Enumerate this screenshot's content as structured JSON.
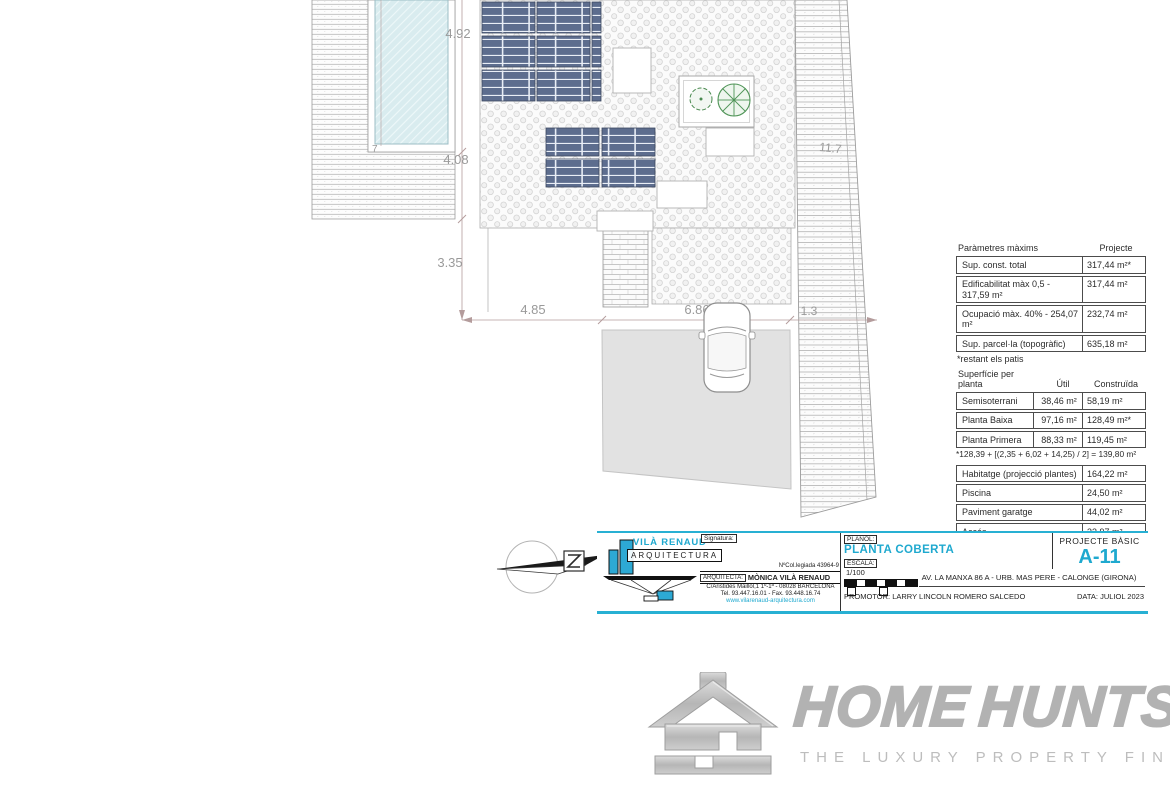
{
  "colors": {
    "accent_cyan": "#28b0d3",
    "panel_blue": "#5d6d8e",
    "tree_green": "#4f9457",
    "dimension_gray": "#9a9a9a",
    "watermark_gray": "#b2b2b2"
  },
  "plan": {
    "dim_pool_height": "4.92",
    "dim_deck_height": "4.08",
    "dim_mid_height": "3.35",
    "dim_left_width": "4.85",
    "dim_garage_width": "6.86",
    "dim_right_width": "1.3",
    "dim_ramp_length": "11.7",
    "dim_pool_inner": "7"
  },
  "params_table": {
    "header": {
      "left": "Paràmetres màxims",
      "right": "Projecte"
    },
    "rows": [
      {
        "label": "Sup. const. total",
        "value": "317,44 m²*"
      },
      {
        "label": "Edificabilitat màx 0,5 - 317,59 m²",
        "value": "317,44 m²"
      },
      {
        "label": "Ocupació màx. 40% - 254,07 m²",
        "value": "232,74 m²"
      },
      {
        "label": "Sup. parcel·la (topogràfic)",
        "value": "635,18 m²"
      }
    ],
    "footnote": "*restant els patis"
  },
  "surface_table": {
    "header": {
      "col1": "Superfície per planta",
      "col2": "Útil",
      "col3": "Construïda"
    },
    "rows": [
      {
        "label": "Semisoterrani",
        "util": "38,46 m²",
        "built": "58,19 m²"
      },
      {
        "label": "Planta Baixa",
        "util": "97,16 m²",
        "built": "128,49 m²*"
      },
      {
        "label": "Planta Primera",
        "util": "88,33 m²",
        "built": "119,45 m²"
      }
    ],
    "footnote": "*128,39 + [(2,35 + 6,02 + 14,25) / 2] = 139,80 m²"
  },
  "areas_table": {
    "rows": [
      {
        "label": "Habitatge (projecció plantes)",
        "value": "164,22 m²"
      },
      {
        "label": "Piscina",
        "value": "24,50 m²"
      },
      {
        "label": "Paviment garatge",
        "value": "44,02 m²"
      },
      {
        "label": "Accés",
        "value": "33,97 m²"
      },
      {
        "label": "Terrassa",
        "value": "59,15 m²"
      }
    ]
  },
  "title_block": {
    "studio_name": "VILÀ RENAUD",
    "studio_sub": "ARQUITECTURA",
    "signature_label": "Signatura:",
    "college_number": "NºCol.legiada 43964-9",
    "architect_label": "ARQUITECTA:",
    "architect_name": "MÒNICA VILÀ RENAUD",
    "architect_address": "C/Aristides Maillol,1 1º-1ª - 08028 BARCELONA",
    "architect_phone": "Tel. 93.447.16.01 - Fax. 93.448.16.74",
    "website": "www.vilarenaud-arquitectura.com",
    "plan_label": "PLANOL:",
    "plan_name": "PLANTA COBERTA",
    "scale_label": "ESCALA:",
    "scale_value": "1/100",
    "project_type": "PROJECTE BÀSIC",
    "sheet_number": "A-11",
    "site_address": "AV. LA MANXA 86 A - URB. MAS PERE - CALONGE (GIRONA)",
    "promoter": "PROMOTOR: LARRY LINCOLN ROMERO SALCEDO",
    "date": "DATA: JULIOL 2023"
  },
  "watermark": {
    "brand_part1": "HOME",
    "brand_part2": "HUNTS",
    "tagline": "THE LUXURY PROPERTY FINDERS"
  }
}
